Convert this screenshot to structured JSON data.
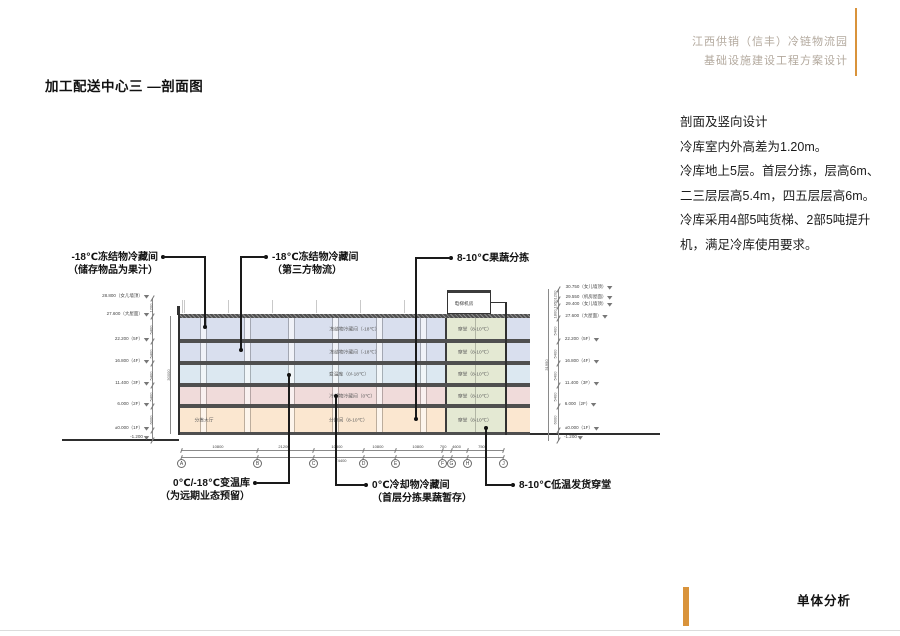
{
  "header": {
    "line1": "江西供销（信丰）冷链物流园",
    "line2": "基础设施建设工程方案设计"
  },
  "title": "加工配送中心三 —剖面图",
  "notes": {
    "heading": "剖面及竖向设计",
    "lines": [
      "冷库室内外高差为1.20m。",
      "冷库地上5层。首层分拣，层高6m、",
      "二三层层高5.4m，四五层层高6m。",
      "冷库采用4部5吨货梯、2部5吨提升",
      "机，满足冷库使用要求。"
    ]
  },
  "footer": {
    "label": "单体分析"
  },
  "colors": {
    "accent_orange": "#D9933B",
    "header_text": "#B3A99E",
    "floor_freezer": "#D9DFEE",
    "floor_variable_temp": "#DCE8F1",
    "floor_chilled": "#F0DBDA",
    "floor_sorting": "#FBE7D0",
    "corridor_green": "#E4E9D3",
    "slab_gray": "#4F4F4F"
  },
  "callouts": {
    "c1": {
      "line1": "-18℃冻结物冷藏间",
      "line2": "（储存物品为果汁）"
    },
    "c2": {
      "line1": "-18℃冻结物冷藏间",
      "line2": "（第三方物流）"
    },
    "c3": {
      "line1": "8-10℃果蔬分拣",
      "line2": ""
    },
    "c4": {
      "line1": "0℃/-18℃变温库",
      "line2": "（为远期业态预留）"
    },
    "c5": {
      "line1": "0℃冷却物冷藏间",
      "line2": "（首层分拣果蔬暂存）"
    },
    "c6": {
      "line1": "8-10℃低温发货穿堂",
      "line2": ""
    }
  },
  "section": {
    "floors": [
      {
        "level": "5F",
        "label": "冻结物冷藏间（-18℃）"
      },
      {
        "level": "4F",
        "label": "冻结物冷藏间（-18℃）"
      },
      {
        "level": "3F",
        "label": "变温库（0/-18℃）"
      },
      {
        "level": "2F",
        "label": "冷却物冷藏间（0℃）"
      },
      {
        "level": "1F",
        "label": "分拣间（8-10℃）",
        "label_left": "分拣大厅"
      }
    ],
    "corridor_label": "穿堂（8-10℃）",
    "penthouse_label": "电梯机房",
    "left_levels": [
      "28.800（女儿墙顶）",
      "27.600（大屋面）",
      "22.200（5F）",
      "16.800（4F）",
      "11.400（3F）",
      "6.000（2F）",
      "±0.000（1F）",
      "-1.200"
    ],
    "left_dim_segments": [
      "1200",
      "5400",
      "5400",
      "5400",
      "5400",
      "6000"
    ],
    "left_dim_total": "30000",
    "right_levels": [
      "30.750（女儿墙顶）",
      "29.550（机房屋面）",
      "29.400（女儿墙顶）",
      "27.600（大屋面）",
      "22.200（5F）",
      "16.800（4F）",
      "11.400（3F）",
      "6.000（2F）",
      "±0.000（1F）",
      "-1.200"
    ],
    "right_dim_segments": [
      "1200",
      "1950",
      "1800",
      "5400",
      "5400",
      "5400",
      "5400",
      "6000"
    ],
    "right_dim_total": "31950",
    "grid_bubbles": [
      "A",
      "B",
      "C",
      "D",
      "E",
      "F",
      "G",
      "H",
      "J"
    ],
    "dims_row1": [
      "10800",
      "21200",
      "10800",
      "10800",
      "10800",
      "700",
      "4600",
      "7500"
    ],
    "dims_total": "74400"
  }
}
